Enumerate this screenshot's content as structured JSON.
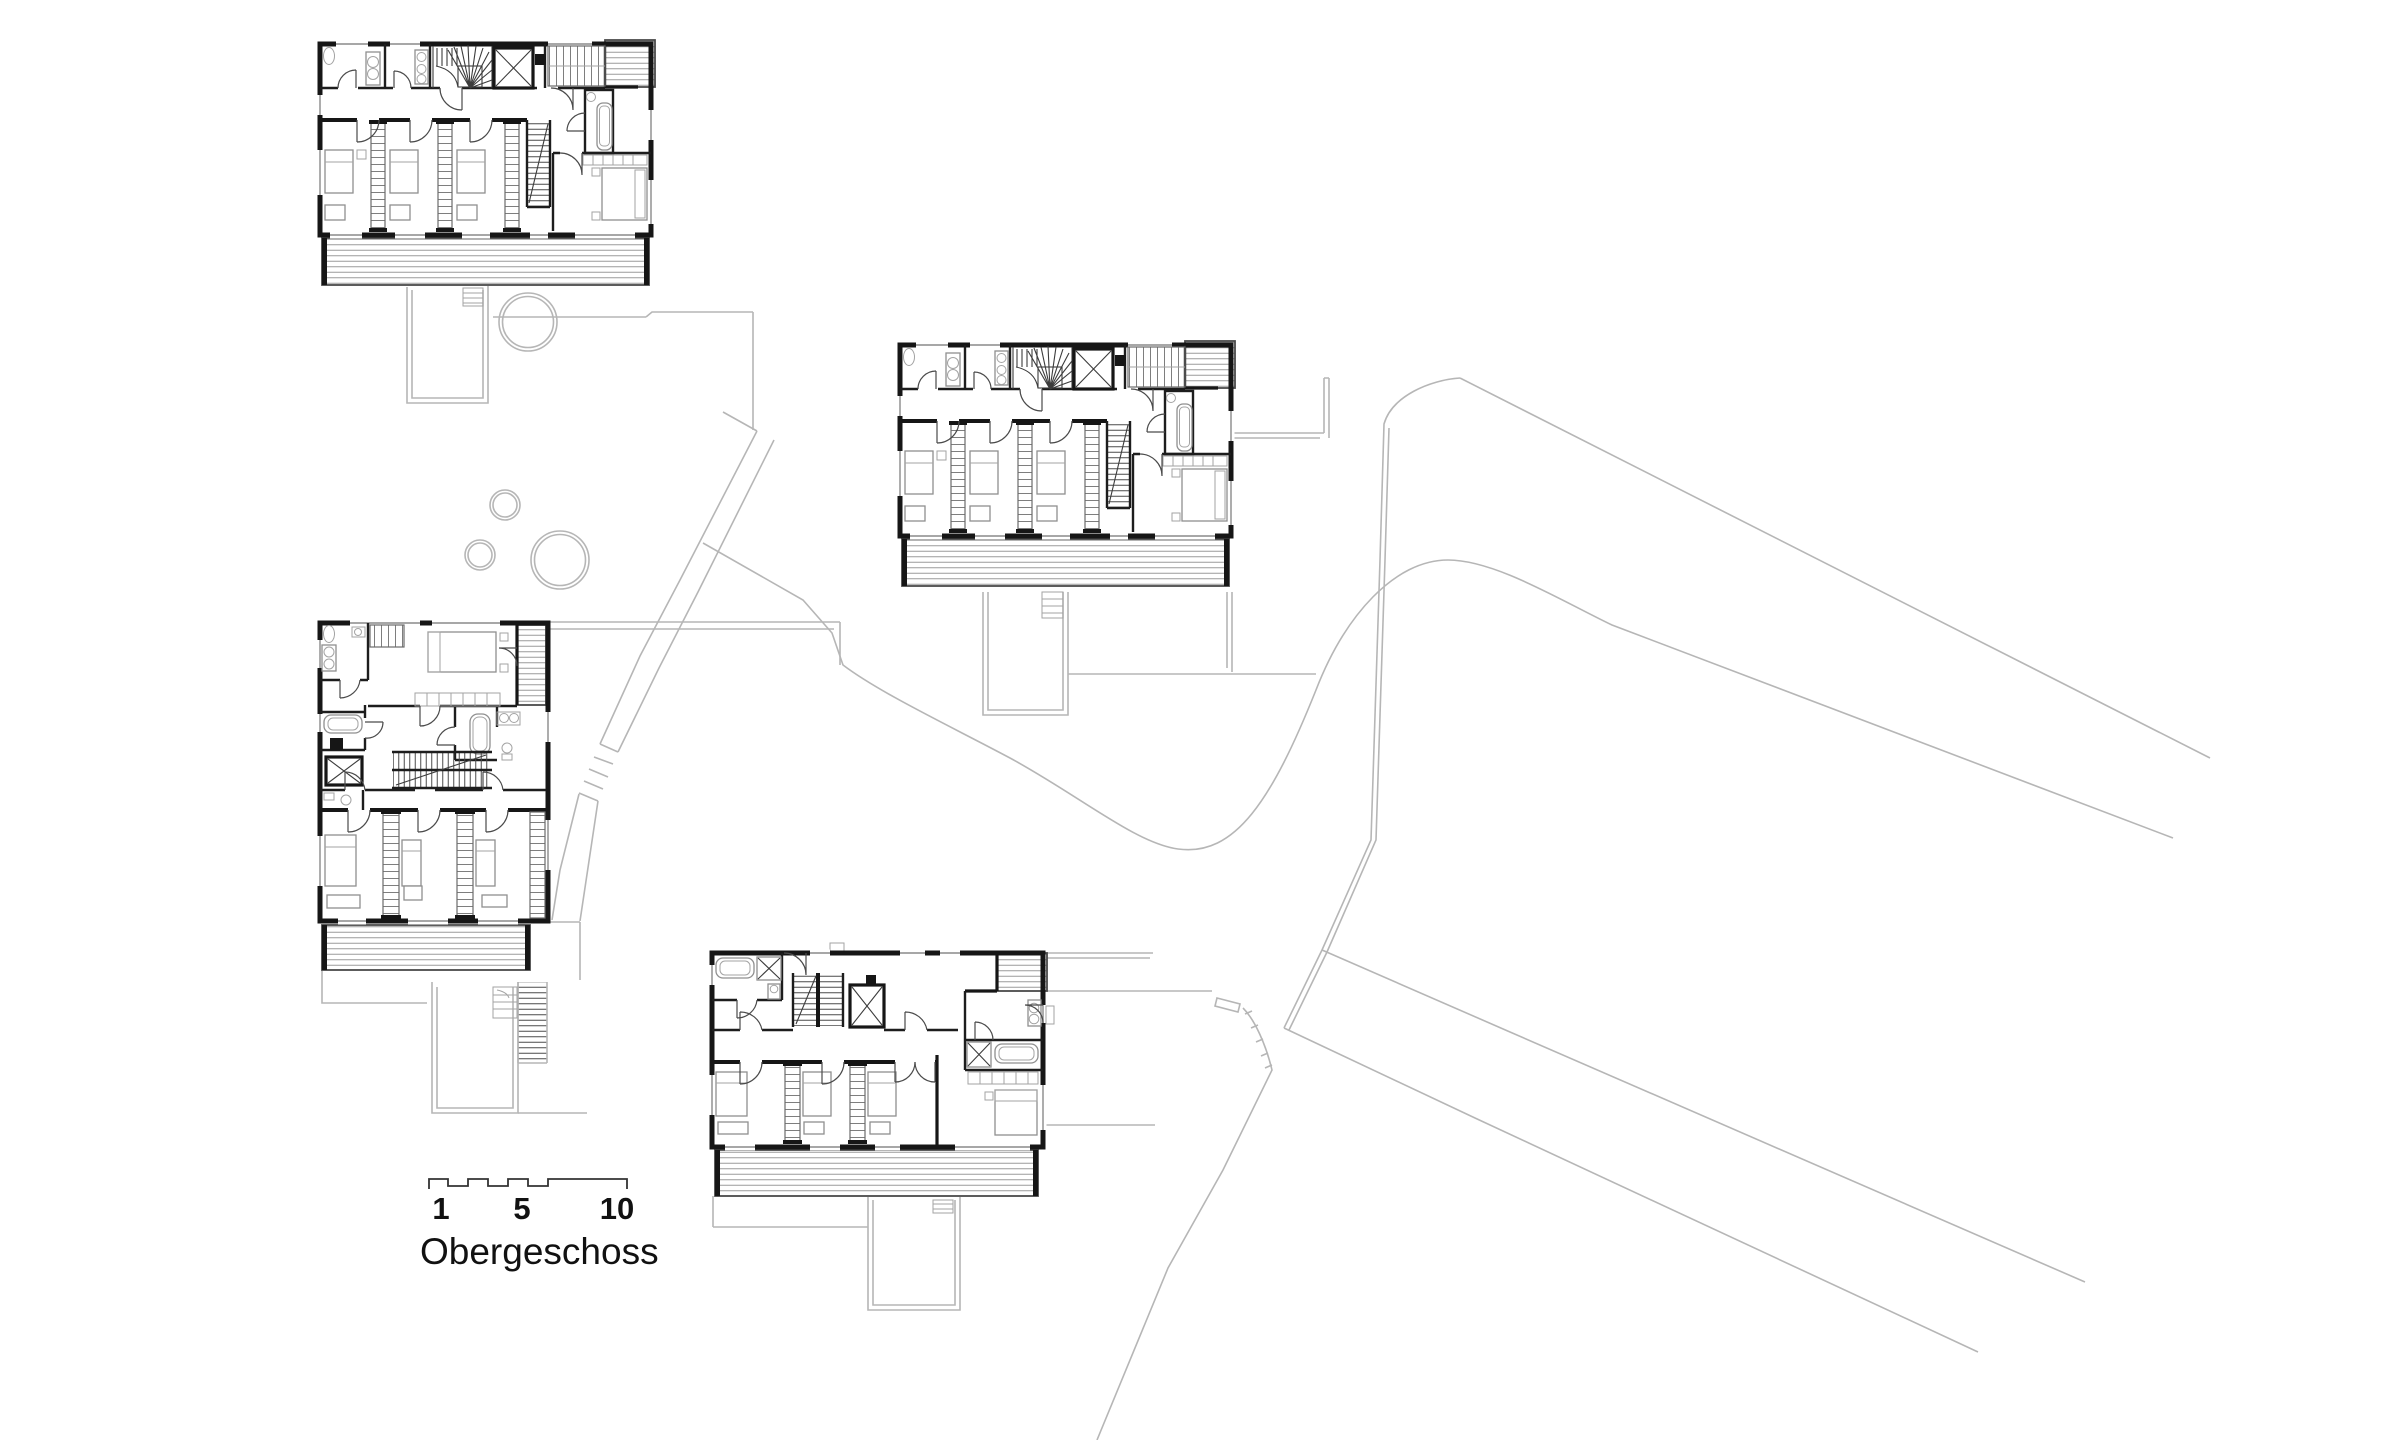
{
  "canvas": {
    "width": 2400,
    "height": 1440,
    "background": "#ffffff"
  },
  "plan": {
    "label": "Obergeschoss",
    "scale_bar": {
      "ticks": [
        "1",
        "5",
        "10"
      ]
    },
    "colors": {
      "ink": "#161616",
      "furniture": "#8f8f8f",
      "site_lines": "#b6b6b6",
      "deck_hatch": "#9b9b9b",
      "background": "#ffffff"
    },
    "buildings": [
      {
        "name": "house-northwest"
      },
      {
        "name": "house-center"
      },
      {
        "name": "house-west"
      },
      {
        "name": "house-south"
      }
    ]
  }
}
